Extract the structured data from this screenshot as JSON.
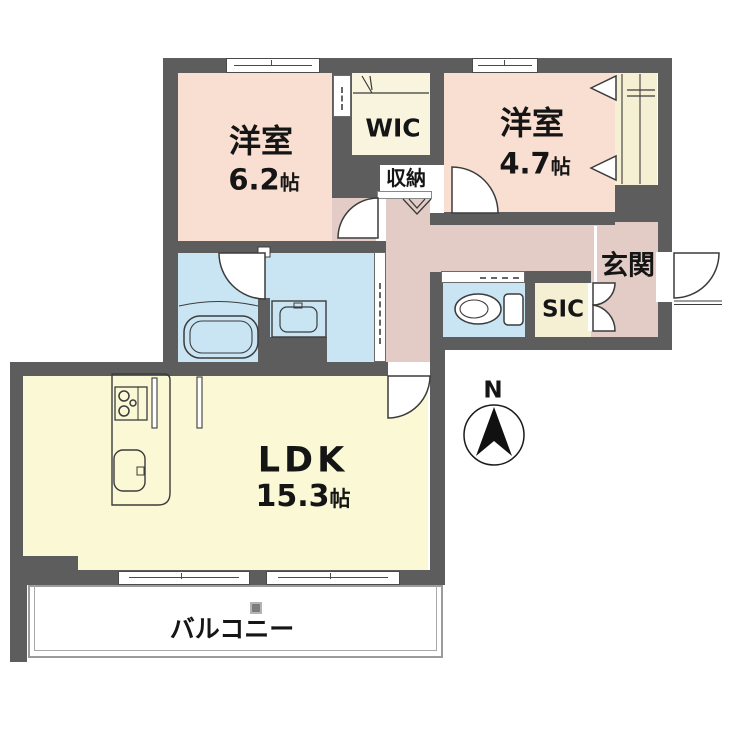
{
  "plan": {
    "type": "apartment-floor-plan",
    "rooms": {
      "bedroom1": {
        "name": "洋室",
        "size": "6.2",
        "unit": "帖"
      },
      "bedroom2": {
        "name": "洋室",
        "size": "4.7",
        "unit": "帖"
      },
      "ldk": {
        "name": "LDK",
        "size": "15.3",
        "unit": "帖"
      },
      "wic": {
        "label": "WIC"
      },
      "storage": {
        "label": "収納"
      },
      "entrance": {
        "label": "玄関"
      },
      "sic": {
        "label": "SIC"
      },
      "balcony": {
        "label": "バルコニー"
      }
    },
    "compass": {
      "label": "N"
    },
    "colors": {
      "wall": "#5d5d5d",
      "bedroom_floor": "#f8dfd2",
      "hallway_floor": "#e3ccc6",
      "ldk_floor": "#faf8d5",
      "wet_area_floor": "#c9e5f3",
      "closet_floor": "#f5efd3"
    }
  }
}
